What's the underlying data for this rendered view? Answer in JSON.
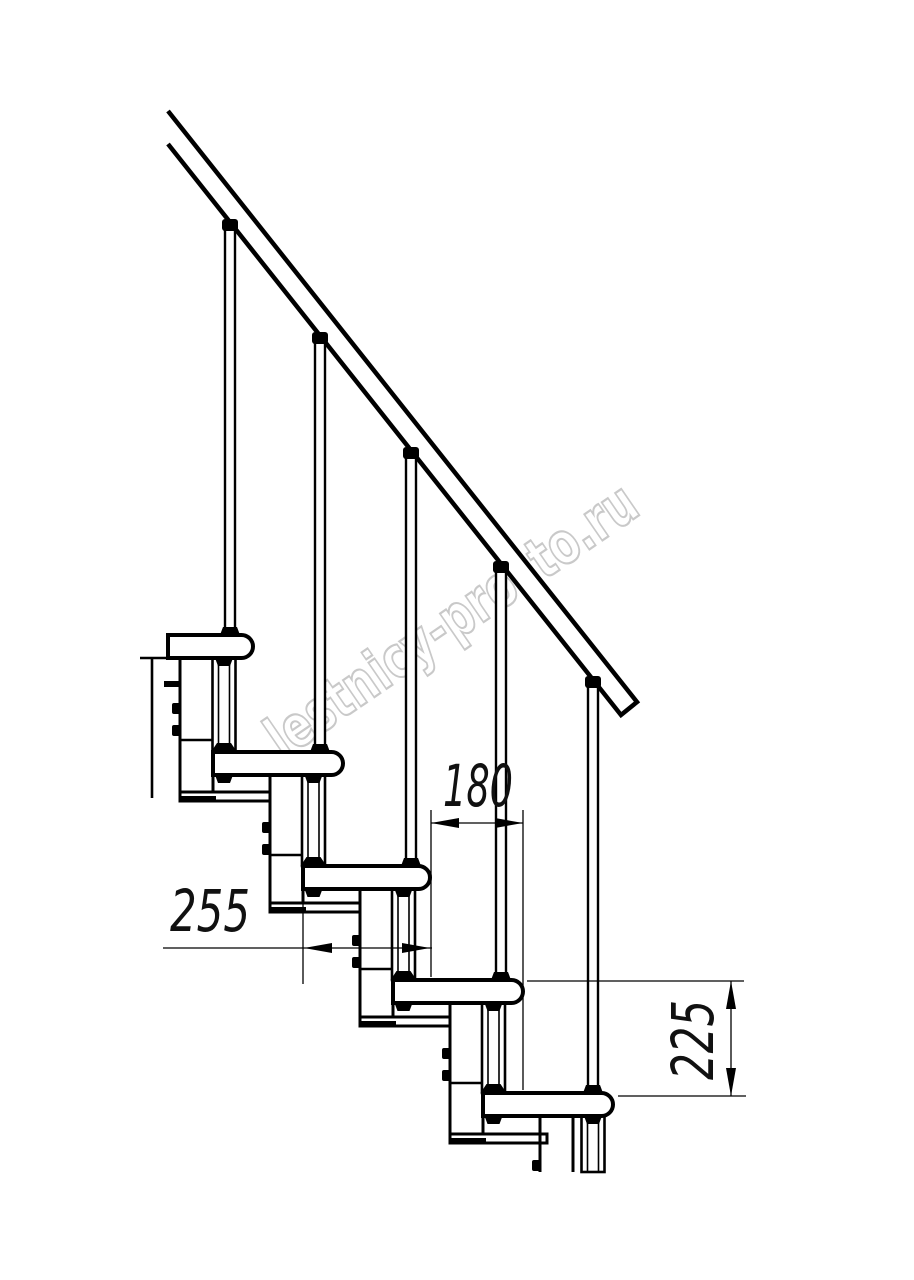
{
  "page": {
    "width": 914,
    "height": 1280,
    "background": "#ffffff"
  },
  "drawing": {
    "kind": "staircase-side-elevation",
    "line_color": "#000000",
    "watermark": {
      "text": "lestnicy-prosto.ru",
      "color": "#c9c9c9"
    },
    "structure": {
      "treads": 5,
      "balusters": 5,
      "support_modules": 5
    },
    "dimensions": [
      {
        "name": "tread-depth",
        "value": "255"
      },
      {
        "name": "step-run",
        "value": "180"
      },
      {
        "name": "step-rise",
        "value": "225"
      }
    ]
  }
}
